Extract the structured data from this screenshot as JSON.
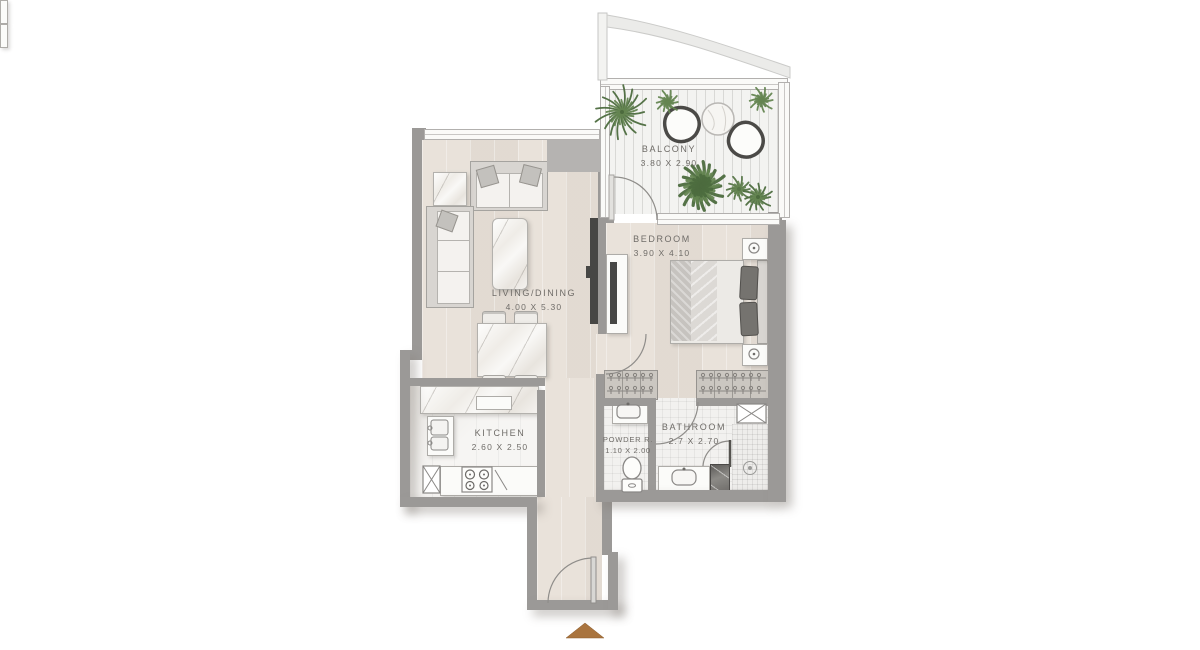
{
  "rooms": [
    {
      "key": "balcony",
      "label": "BALCONY",
      "dims": "3.80 X 2.90"
    },
    {
      "key": "bedroom",
      "label": "BEDROOM",
      "dims": "3.90 X 4.10"
    },
    {
      "key": "living-dining",
      "label": "LIVING/DINING",
      "dims": "4.00 X 5.30"
    },
    {
      "key": "kitchen",
      "label": "KITCHEN",
      "dims": "2.60 X 2.50"
    },
    {
      "key": "powder-room",
      "label": "POWDER R.",
      "dims": "1.10 X 2.00"
    },
    {
      "key": "bathroom",
      "label": "BATHROOM",
      "dims": "2.7 X 2.70"
    }
  ],
  "colors": {
    "wall": "#9b9997",
    "wall_light": "#b5b3b1",
    "floor": "#e9e2da",
    "balcony_floor": "#f3f3f1",
    "label_text": "#6f6c68",
    "plant_dark": "#4c6b3e",
    "plant_mid": "#567547",
    "plant_light": "#648551",
    "entry_arrow": "#a9743e",
    "tv_black": "#474745",
    "outline_dark": "#4b4a47"
  }
}
